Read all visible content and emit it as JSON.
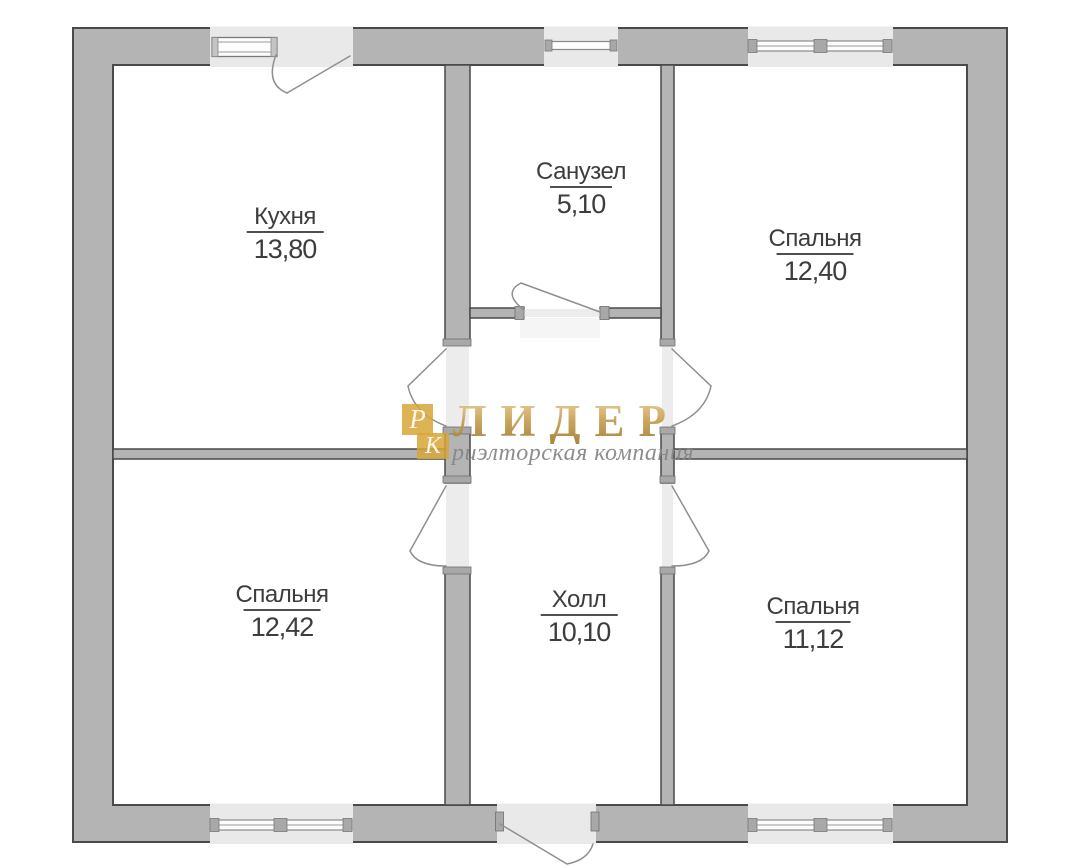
{
  "plan": {
    "colors": {
      "wall_fill": "#b4b4b4",
      "wall_outline": "#4a4a4a",
      "opening_fill": "#ececec",
      "label_color": "#3d3d3d"
    },
    "rooms": [
      {
        "name": "Кухня",
        "area": "13,80"
      },
      {
        "name": "Санузел",
        "area": "5,10"
      },
      {
        "name": "Спальня",
        "area": "12,40"
      },
      {
        "name": "Спальня",
        "area": "12,42"
      },
      {
        "name": "Холл",
        "area": "10,10"
      },
      {
        "name": "Спальня",
        "area": "11,12"
      }
    ]
  },
  "watermark": {
    "logo_top_letter": "Р",
    "logo_bottom_letter": "К",
    "brand": "ЛИДЕР",
    "tagline": "риэлторская компания",
    "logo_color": "#d8a637",
    "brand_color": "#c49e54",
    "tagline_color": "#878787"
  }
}
